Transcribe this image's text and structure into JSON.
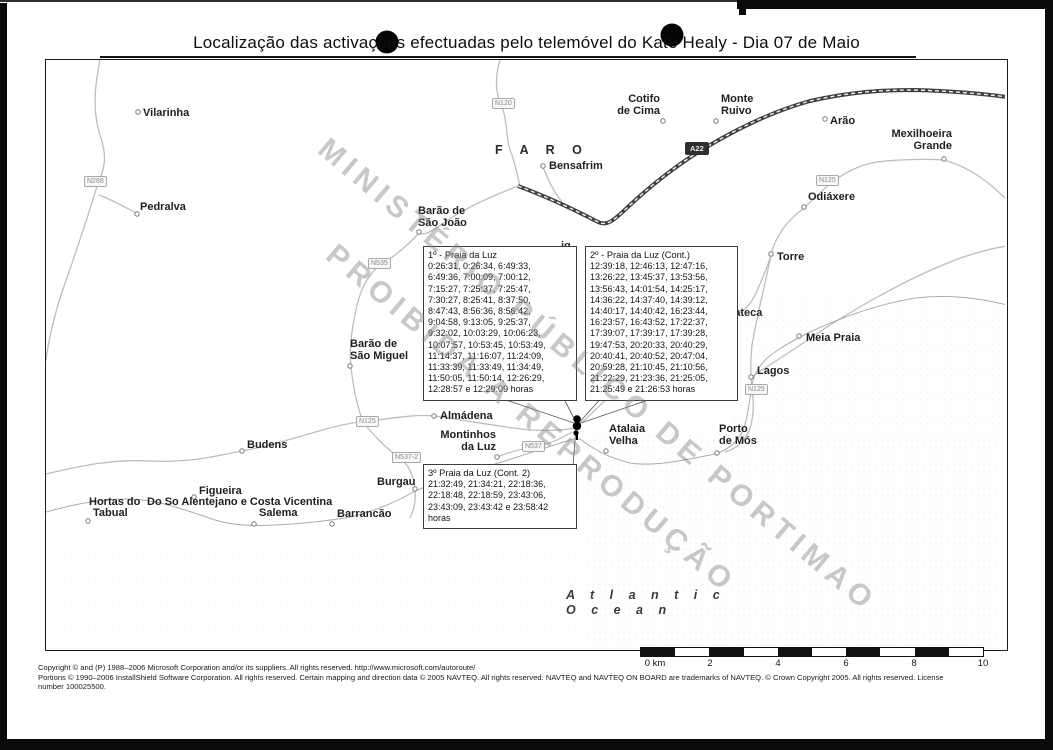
{
  "title": "Localização das activações efectuadas pelo telemóvel do Kate Healy - Dia 07 de Maio",
  "watermark": {
    "line1": "MINISTÉRIO PÚBLICO DE PORTIMAO",
    "line2": "PROIBIDA A REPRODUÇÃO"
  },
  "map": {
    "region_label": "F A R O",
    "ocean_label": "A t l a n t i c\nO c e a n",
    "places": [
      {
        "label": "Vilarinha"
      },
      {
        "label": "Pedralva"
      },
      {
        "label": "Barão de\nSão João"
      },
      {
        "label": "Barão de\nSão Miguel"
      },
      {
        "label": "Budens"
      },
      {
        "label": "Figueira"
      },
      {
        "label": "Hortas do"
      },
      {
        "label": "Do So Alentejano e Costa Vicentina"
      },
      {
        "label": "Tabual"
      },
      {
        "label": "Salema"
      },
      {
        "label": "Barrancão"
      },
      {
        "label": "Burgau"
      },
      {
        "label": "Almádena"
      },
      {
        "label": "Montinhos\nda Luz"
      },
      {
        "label": "Atalaia\nVelha"
      },
      {
        "label": "Porto\nde Mós"
      },
      {
        "label": "Lagos"
      },
      {
        "label": "Meia Praia"
      },
      {
        "label": "Torre"
      },
      {
        "label": "Odiáxere"
      },
      {
        "label": "Arão"
      },
      {
        "label": "Mexilhoeira\nGrande"
      },
      {
        "label": "Cotifo\nde Cima"
      },
      {
        "label": "Monte\nRuivo"
      },
      {
        "label": "Bensafrim"
      }
    ],
    "partial_labels": {
      "p1": "ig",
      "p2": "te",
      "p3": "rateca"
    },
    "road_badges": [
      {
        "label": "N268"
      },
      {
        "label": "N120"
      },
      {
        "label": "A22"
      },
      {
        "label": "N125"
      },
      {
        "label": "N535"
      },
      {
        "label": "N125"
      },
      {
        "label": "N125"
      },
      {
        "label": "N537"
      },
      {
        "label": "N537-2"
      }
    ]
  },
  "callouts": [
    {
      "title": "1º - Praia da Luz",
      "lines": [
        "0:26:31, 0:26:34, 6:49:33,",
        "6:49:36, 7:00:09, 7:00:12,",
        "7:15:27, 7:25:37, 7:25:47,",
        "7:30:27, 8:25:41, 8:37:50,",
        "8:47:43, 8:56:36, 8:56:42,",
        "9:04:58, 9:13:05, 9:25:37,",
        "9:32:02, 10:03:29, 10:06:23,",
        "10:07:57, 10:53:45, 10:53:49,",
        "11:14:37, 11:16:07, 11:24:09,",
        "11:33:39, 11:33:49, 11:34:49,",
        "11:50:05, 11:50:14, 12:26:29,",
        "12:28:57 e 12:29:09 horas"
      ]
    },
    {
      "title": "2º - Praia da Luz (Cont.)",
      "lines": [
        "12:39:18, 12:46:13, 12:47:16,",
        "13:26:22, 13:45:37, 13:53:56,",
        "13:56:43, 14:01:54, 14:25:17,",
        "14:36:22, 14:37:40, 14:39:12,",
        "14:40:17, 14:40:42, 16:23:44,",
        "16:23:57, 16:43:52, 17:22:37,",
        "17:39:07, 17:39:17, 17:39:28,",
        "19:47:53, 20:20:33, 20:40:29,",
        "20:40:41, 20:40:52, 20:47:04,",
        "20:59:28, 21:10:45, 21:10:56,",
        "21:22:29, 21:23:36, 21:25:05,",
        "21:25:49 e 21:26:53 horas"
      ]
    },
    {
      "title": "3º Praia da Luz (Cont. 2)",
      "lines": [
        "21:32:49, 21:34:21, 22:18:36,",
        "22:18:48, 22:18:59, 23:43:06,",
        "23:43:09, 23:43:42 e 23:58:42",
        "horas"
      ]
    }
  ],
  "scale_bar": {
    "labels": [
      "0 km",
      "2",
      "4",
      "6",
      "8",
      "10"
    ]
  },
  "footer": {
    "line1": "Copyright © and (P) 1988–2006 Microsoft Corporation and/or its suppliers. All rights reserved. http://www.microsoft.com/autoroute/",
    "line2": "Portions © 1990–2006 InstallShield Software Corporation. All rights reserved. Certain mapping and direction data © 2005 NAVTEQ. All rights reserved. NAVTEQ and NAVTEQ ON BOARD are trademarks of NAVTEQ. © Crown Copyright 2005. All rights reserved. License",
    "line3": "number 100025500."
  }
}
